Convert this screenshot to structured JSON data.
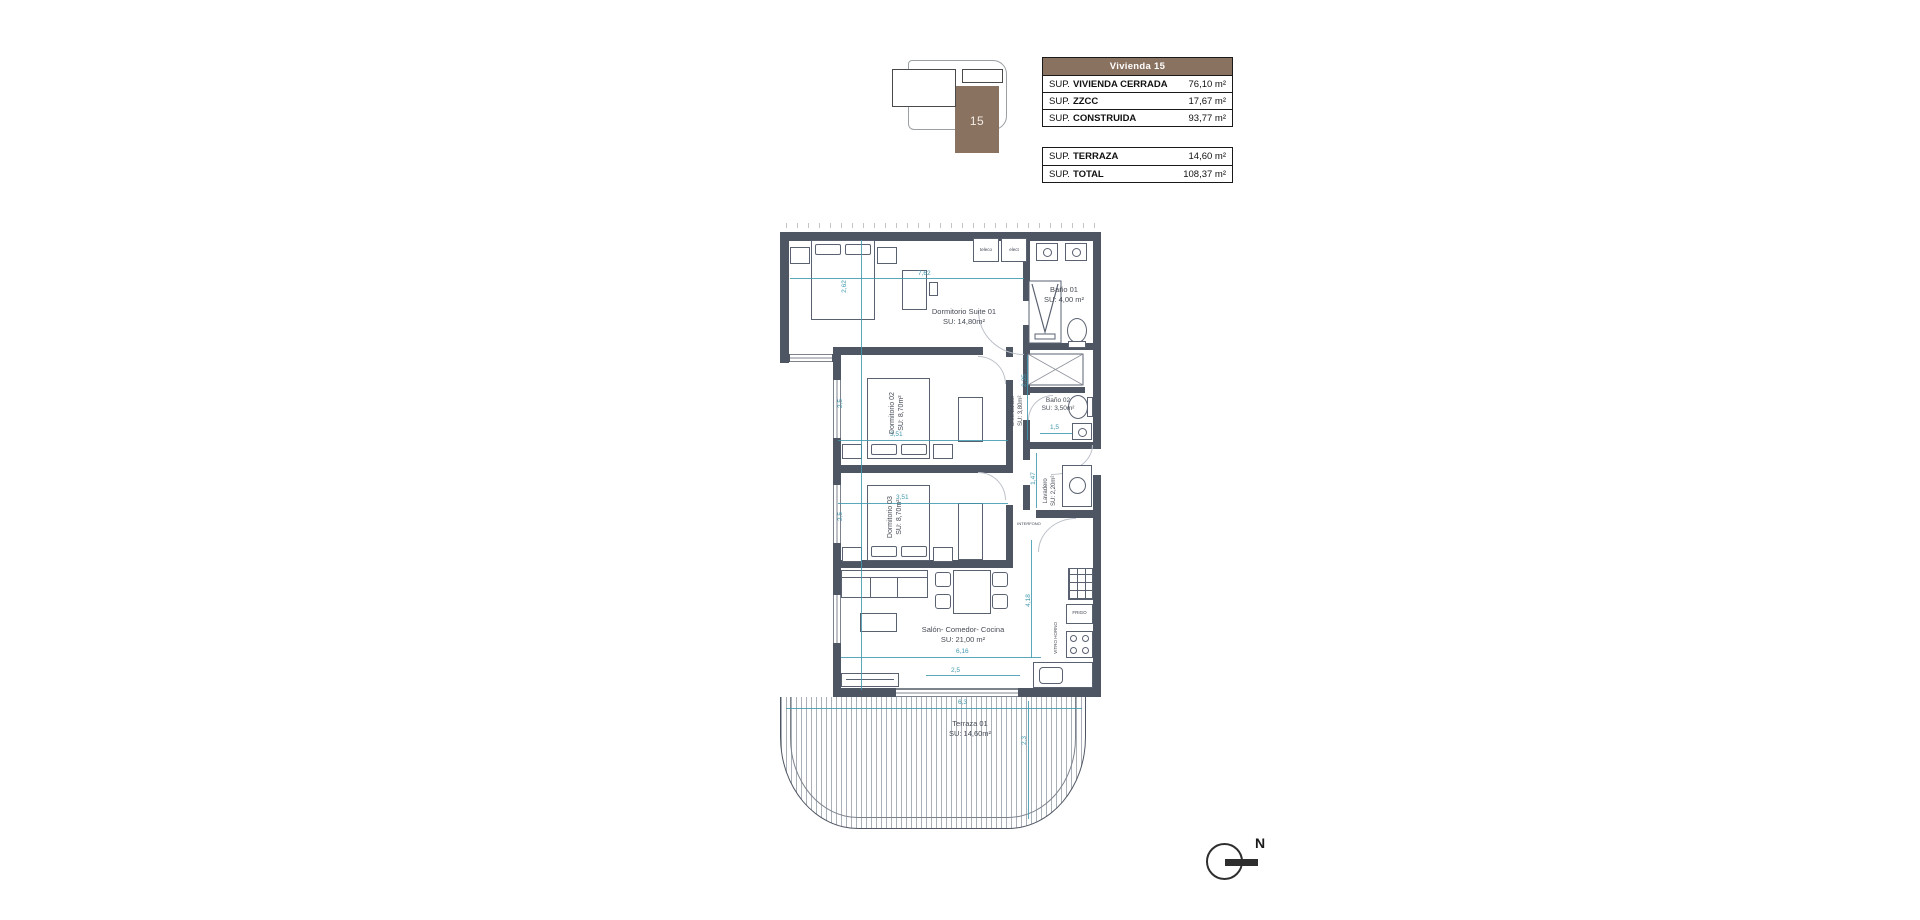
{
  "key_plan": {
    "unit": "15"
  },
  "tables": {
    "vivienda": {
      "header": "Vivienda 15",
      "rows": [
        {
          "prefix": "SUP.",
          "name": "VIVIENDA CERRADA",
          "value": "76,10 m²"
        },
        {
          "prefix": "SUP.",
          "name": "ZZCC",
          "value": "17,67 m²"
        },
        {
          "prefix": "SUP.",
          "name": "CONSTRUIDA",
          "value": "93,77 m²"
        }
      ]
    },
    "totals": {
      "rows": [
        {
          "prefix": "SUP.",
          "name": "TERRAZA",
          "value": "14,60 m²"
        },
        {
          "prefix": "SUP.",
          "name": "TOTAL",
          "value": "108,37 m²"
        }
      ]
    }
  },
  "rooms": {
    "suite": {
      "name": "Dormitorio Suite 01",
      "area": "SU: 14,80m²"
    },
    "bano1": {
      "name": "Baño 01",
      "area": "SU: 4,00 m²"
    },
    "dorm2": {
      "name": "Dormitorio 02",
      "area": "SU: 8,70m²"
    },
    "bano2": {
      "name": "Baño 02",
      "area": "SU: 3,50m²"
    },
    "distribuidor": {
      "name": "Distribuidor",
      "area": "SU: 3,80m²"
    },
    "dorm3": {
      "name": "Dormitorio 03",
      "area": "SU: 8,70m²"
    },
    "lavadero": {
      "name": "Lavadero",
      "area": "SU: 2,20m²"
    },
    "salon": {
      "name": "Salón- Comedor- Cocina",
      "area": "SU: 21,00 m²"
    },
    "terraza": {
      "name": "Terraza 01",
      "area": "SU: 14,60m²"
    }
  },
  "dimensions": {
    "suite_w": "7,62",
    "suite_h": "2,62",
    "dorm2_h": "2,5",
    "dorm2_w": "3,51",
    "dorm3_h": "2,5",
    "dorm3_w": "3,51",
    "bano2_h": "2,35",
    "bano2_w": "1,5",
    "lavadero_h": "1,47",
    "salon_w": "6,16",
    "salon_w2": "2,5",
    "kitchen_h": "4,18",
    "terraza_w": "6,3",
    "terraza_h": "2,3"
  },
  "labels": {
    "teleco": "teleco",
    "elect": "elect",
    "frigo": "FRIGO",
    "vitro": "VITRO HORNO",
    "interfono": "INTERFONO"
  },
  "compass": {
    "north": "N"
  },
  "colors": {
    "wall": "#4f5663",
    "dimension": "#3f98ae",
    "brand_brown": "#8a7261"
  }
}
